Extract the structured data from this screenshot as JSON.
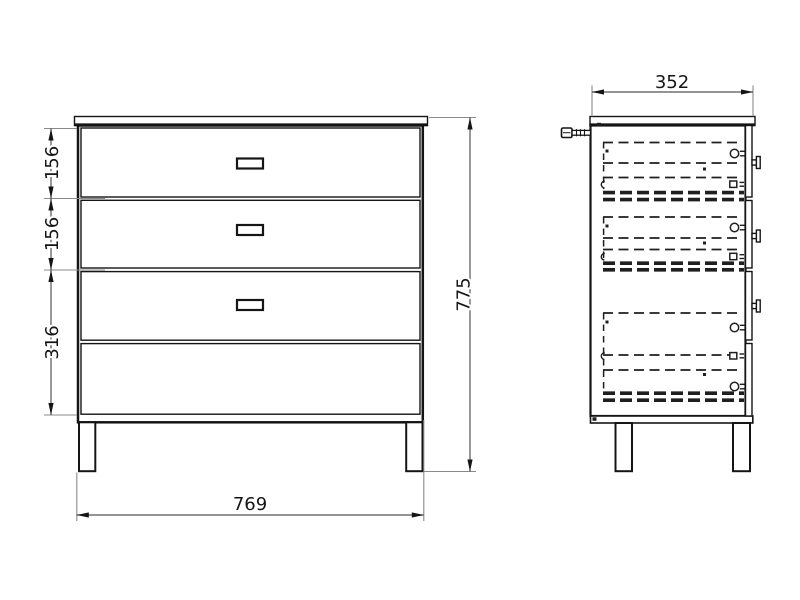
{
  "dimensions": {
    "front": {
      "drawer1_height": "156",
      "drawer2_height": "156",
      "lower_section_height": "316",
      "overall_height": "775",
      "overall_width": "769"
    },
    "side": {
      "depth": "352"
    }
  },
  "colors": {
    "background": "#ffffff",
    "object_line": "#151515",
    "hidden_line": "#1f1f1f",
    "dimension_line": "#555555",
    "extension_line": "#8a8a8a",
    "text": "#151515"
  }
}
